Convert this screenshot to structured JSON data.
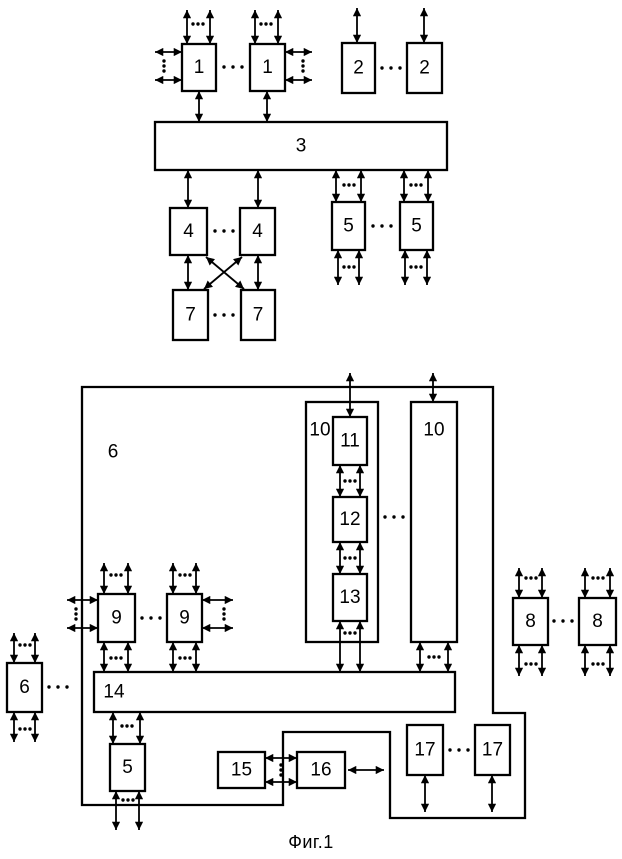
{
  "figure": {
    "caption": "Фиг.1"
  },
  "colors": {
    "line": "#000000",
    "background": "#ffffff",
    "box_fill": "#ffffff"
  },
  "diagram": {
    "container": {
      "id": "unit-6",
      "label": "6",
      "points": "82,387 493,387 493,713 525,713 525,818 390,818 390,732 283,732 283,805 82,805",
      "lx": 113,
      "ly": 452
    },
    "boxes": [
      {
        "id": "unit-1a",
        "label": "1",
        "x": 182,
        "y": 44,
        "w": 34,
        "h": 47
      },
      {
        "id": "unit-1b",
        "label": "1",
        "x": 250,
        "y": 44,
        "w": 35,
        "h": 47
      },
      {
        "id": "unit-2a",
        "label": "2",
        "x": 342,
        "y": 43,
        "w": 33,
        "h": 50
      },
      {
        "id": "unit-2b",
        "label": "2",
        "x": 407,
        "y": 43,
        "w": 35,
        "h": 50
      },
      {
        "id": "unit-3",
        "label": "3",
        "x": 155,
        "y": 122,
        "w": 292,
        "h": 48
      },
      {
        "id": "unit-4a",
        "label": "4",
        "x": 170,
        "y": 208,
        "w": 37,
        "h": 47
      },
      {
        "id": "unit-4b",
        "label": "4",
        "x": 240,
        "y": 208,
        "w": 35,
        "h": 47
      },
      {
        "id": "unit-5a",
        "label": "5",
        "x": 332,
        "y": 202,
        "w": 33,
        "h": 48
      },
      {
        "id": "unit-5b",
        "label": "5",
        "x": 400,
        "y": 202,
        "w": 33,
        "h": 48
      },
      {
        "id": "unit-7a",
        "label": "7",
        "x": 173,
        "y": 290,
        "w": 35,
        "h": 50
      },
      {
        "id": "unit-7b",
        "label": "7",
        "x": 241,
        "y": 290,
        "w": 34,
        "h": 50
      },
      {
        "id": "unit-10a",
        "label": "10",
        "x": 306,
        "y": 402,
        "w": 72,
        "h": 240,
        "lx": 320,
        "ly": 430
      },
      {
        "id": "unit-10b",
        "label": "10",
        "x": 411,
        "y": 402,
        "w": 46,
        "h": 240,
        "lx": 434,
        "ly": 430
      },
      {
        "id": "unit-11",
        "label": "11",
        "x": 333,
        "y": 417,
        "w": 34,
        "h": 48
      },
      {
        "id": "unit-12",
        "label": "12",
        "x": 333,
        "y": 497,
        "w": 34,
        "h": 45
      },
      {
        "id": "unit-13",
        "label": "13",
        "x": 333,
        "y": 574,
        "w": 34,
        "h": 47
      },
      {
        "id": "unit-9a",
        "label": "9",
        "x": 98,
        "y": 594,
        "w": 37,
        "h": 48
      },
      {
        "id": "unit-9b",
        "label": "9",
        "x": 167,
        "y": 594,
        "w": 35,
        "h": 48
      },
      {
        "id": "unit-8a",
        "label": "8",
        "x": 513,
        "y": 598,
        "w": 35,
        "h": 47
      },
      {
        "id": "unit-8b",
        "label": "8",
        "x": 579,
        "y": 598,
        "w": 37,
        "h": 47
      },
      {
        "id": "unit-6-ext",
        "label": "6",
        "x": 7,
        "y": 663,
        "w": 35,
        "h": 49
      },
      {
        "id": "unit-14",
        "label": "14",
        "x": 94,
        "y": 672,
        "w": 361,
        "h": 40,
        "lx": 114,
        "ly": 692
      },
      {
        "id": "unit-5c",
        "label": "5",
        "x": 110,
        "y": 744,
        "w": 35,
        "h": 47
      },
      {
        "id": "unit-15",
        "label": "15",
        "x": 218,
        "y": 752,
        "w": 47,
        "h": 36
      },
      {
        "id": "unit-16",
        "label": "16",
        "x": 297,
        "y": 752,
        "w": 48,
        "h": 36
      },
      {
        "id": "unit-17a",
        "label": "17",
        "x": 407,
        "y": 725,
        "w": 36,
        "h": 50
      },
      {
        "id": "unit-17b",
        "label": "17",
        "x": 475,
        "y": 725,
        "w": 35,
        "h": 50
      }
    ],
    "arrows": [
      [
        187,
        10,
        187,
        44
      ],
      [
        210,
        10,
        210,
        44
      ],
      [
        255,
        10,
        255,
        44
      ],
      [
        278,
        10,
        278,
        44
      ],
      [
        155,
        52,
        182,
        52
      ],
      [
        155,
        80,
        182,
        80
      ],
      [
        285,
        52,
        312,
        52
      ],
      [
        285,
        80,
        312,
        80
      ],
      [
        199,
        91,
        199,
        122
      ],
      [
        267,
        91,
        267,
        122
      ],
      [
        357,
        8,
        357,
        43
      ],
      [
        424,
        8,
        424,
        43
      ],
      [
        188,
        170,
        188,
        208
      ],
      [
        258,
        170,
        258,
        208
      ],
      [
        336,
        170,
        336,
        202
      ],
      [
        361,
        170,
        361,
        202
      ],
      [
        404,
        170,
        404,
        202
      ],
      [
        428,
        170,
        428,
        202
      ],
      [
        188,
        255,
        188,
        290
      ],
      [
        258,
        255,
        258,
        290
      ],
      [
        206,
        257,
        244,
        289
      ],
      [
        242,
        257,
        204,
        289
      ],
      [
        338,
        250,
        338,
        285
      ],
      [
        359,
        250,
        359,
        285
      ],
      [
        405,
        250,
        405,
        285
      ],
      [
        427,
        250,
        427,
        285
      ],
      [
        350,
        373,
        350,
        417
      ],
      [
        433,
        373,
        433,
        402
      ],
      [
        340,
        465,
        340,
        497
      ],
      [
        360,
        465,
        360,
        497
      ],
      [
        340,
        542,
        340,
        574
      ],
      [
        360,
        542,
        360,
        574
      ],
      [
        340,
        621,
        340,
        672
      ],
      [
        360,
        621,
        360,
        672
      ],
      [
        420,
        642,
        420,
        672
      ],
      [
        448,
        642,
        448,
        672
      ],
      [
        104,
        563,
        104,
        594
      ],
      [
        128,
        563,
        128,
        594
      ],
      [
        173,
        563,
        173,
        594
      ],
      [
        196,
        563,
        196,
        594
      ],
      [
        67,
        600,
        98,
        600
      ],
      [
        67,
        628,
        98,
        628
      ],
      [
        202,
        600,
        233,
        600
      ],
      [
        202,
        628,
        233,
        628
      ],
      [
        104,
        642,
        104,
        672
      ],
      [
        128,
        642,
        128,
        672
      ],
      [
        173,
        642,
        173,
        672
      ],
      [
        196,
        642,
        196,
        672
      ],
      [
        113,
        712,
        113,
        744
      ],
      [
        140,
        712,
        140,
        744
      ],
      [
        116,
        791,
        116,
        830
      ],
      [
        139,
        791,
        139,
        830
      ],
      [
        265,
        758,
        297,
        758
      ],
      [
        265,
        782,
        297,
        782
      ],
      [
        348,
        770,
        384,
        770
      ],
      [
        425,
        775,
        425,
        812
      ],
      [
        492,
        775,
        492,
        812
      ],
      [
        519,
        568,
        519,
        598
      ],
      [
        542,
        568,
        542,
        598
      ],
      [
        585,
        568,
        585,
        598
      ],
      [
        610,
        568,
        610,
        598
      ],
      [
        519,
        645,
        519,
        676
      ],
      [
        542,
        645,
        542,
        676
      ],
      [
        585,
        645,
        585,
        676
      ],
      [
        610,
        645,
        610,
        676
      ],
      [
        14,
        633,
        14,
        663
      ],
      [
        35,
        633,
        35,
        663
      ],
      [
        14,
        712,
        14,
        742
      ],
      [
        35,
        712,
        35,
        742
      ]
    ],
    "dots": [
      {
        "x": 198,
        "y": 24,
        "d": "h",
        "g": 5
      },
      {
        "x": 266,
        "y": 24,
        "d": "h",
        "g": 5
      },
      {
        "x": 164,
        "y": 66,
        "d": "v",
        "g": 5
      },
      {
        "x": 303,
        "y": 66,
        "d": "v",
        "g": 5
      },
      {
        "x": 233,
        "y": 67,
        "d": "h",
        "g": 9
      },
      {
        "x": 391,
        "y": 68,
        "d": "h",
        "g": 9
      },
      {
        "x": 349,
        "y": 185,
        "d": "h",
        "g": 5
      },
      {
        "x": 416,
        "y": 185,
        "d": "h",
        "g": 5
      },
      {
        "x": 224,
        "y": 231,
        "d": "h",
        "g": 9
      },
      {
        "x": 382,
        "y": 226,
        "d": "h",
        "g": 9
      },
      {
        "x": 224,
        "y": 315,
        "d": "h",
        "g": 9
      },
      {
        "x": 349,
        "y": 267,
        "d": "h",
        "g": 5
      },
      {
        "x": 416,
        "y": 267,
        "d": "h",
        "g": 5
      },
      {
        "x": 350,
        "y": 481,
        "d": "h",
        "g": 5
      },
      {
        "x": 350,
        "y": 558,
        "d": "h",
        "g": 5
      },
      {
        "x": 350,
        "y": 633,
        "d": "h",
        "g": 5
      },
      {
        "x": 434,
        "y": 657,
        "d": "h",
        "g": 5
      },
      {
        "x": 394,
        "y": 517,
        "d": "h",
        "g": 9
      },
      {
        "x": 116,
        "y": 575,
        "d": "h",
        "g": 5
      },
      {
        "x": 185,
        "y": 575,
        "d": "h",
        "g": 5
      },
      {
        "x": 76,
        "y": 614,
        "d": "v",
        "g": 5
      },
      {
        "x": 224,
        "y": 614,
        "d": "v",
        "g": 5
      },
      {
        "x": 116,
        "y": 658,
        "d": "h",
        "g": 5
      },
      {
        "x": 185,
        "y": 658,
        "d": "h",
        "g": 5
      },
      {
        "x": 151,
        "y": 618,
        "d": "h",
        "g": 9
      },
      {
        "x": 127,
        "y": 726,
        "d": "h",
        "g": 5
      },
      {
        "x": 128,
        "y": 800,
        "d": "h",
        "g": 5
      },
      {
        "x": 281,
        "y": 770,
        "d": "v",
        "g": 5
      },
      {
        "x": 459,
        "y": 750,
        "d": "h",
        "g": 9
      },
      {
        "x": 531,
        "y": 578,
        "d": "h",
        "g": 5
      },
      {
        "x": 598,
        "y": 578,
        "d": "h",
        "g": 5
      },
      {
        "x": 531,
        "y": 664,
        "d": "h",
        "g": 5
      },
      {
        "x": 598,
        "y": 664,
        "d": "h",
        "g": 5
      },
      {
        "x": 563,
        "y": 621,
        "d": "h",
        "g": 9
      },
      {
        "x": 25,
        "y": 645,
        "d": "h",
        "g": 5
      },
      {
        "x": 25,
        "y": 729,
        "d": "h",
        "g": 5
      },
      {
        "x": 58,
        "y": 687,
        "d": "h",
        "g": 9
      }
    ]
  }
}
